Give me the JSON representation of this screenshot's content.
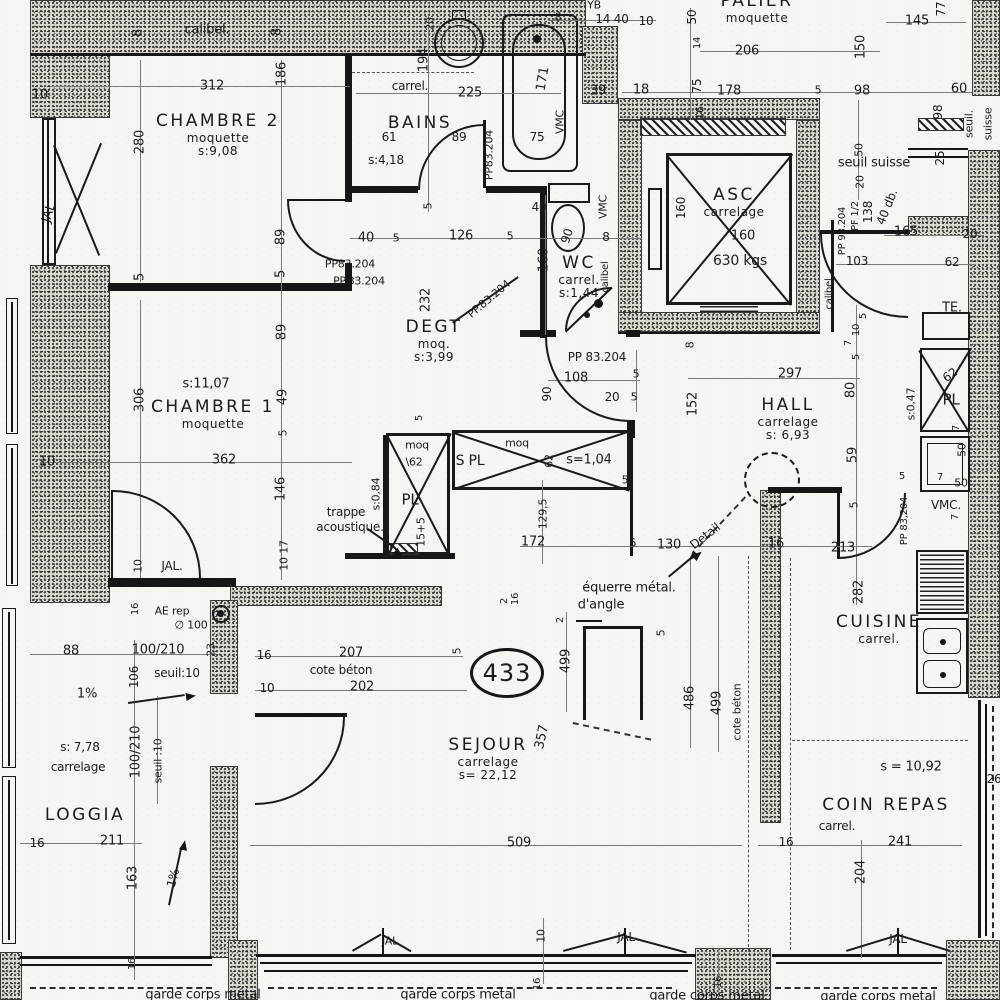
{
  "plan": {
    "number": "433",
    "rooms": [
      {
        "name": "CHAMBRE 2",
        "sub1": "moquette",
        "sub2": "s:9,08",
        "x": 218,
        "y": 112
      },
      {
        "name": "BAINS",
        "sub1": "",
        "sub2": "",
        "x": 420,
        "y": 114
      },
      {
        "name": "WC",
        "sub1": "carrel.",
        "sub2": "s:1,44",
        "x": 579,
        "y": 254
      },
      {
        "name": "DEGT",
        "sub1": "moq.",
        "sub2": "s:3,99",
        "x": 434,
        "y": 318
      },
      {
        "name": "PALIER",
        "sub1": "moquette",
        "sub2": "",
        "x": 757,
        "y": -8
      },
      {
        "name": "ASC",
        "sub1": "carrelage",
        "sub2": "",
        "x": 734,
        "y": 186
      },
      {
        "name": "HALL",
        "sub1": "carrelage",
        "sub2": "s: 6,93",
        "x": 788,
        "y": 396
      },
      {
        "name": "CHAMBRE 1",
        "sub1": "moquette",
        "sub2": "",
        "x": 213,
        "y": 398
      },
      {
        "name": "SEJOUR",
        "sub1": "carrelage",
        "sub2": "s= 22,12",
        "x": 488,
        "y": 736
      },
      {
        "name": "LOGGIA",
        "sub1": "",
        "sub2": "",
        "x": 85,
        "y": 806
      },
      {
        "name": "CUISINE",
        "sub1": "carrel.",
        "sub2": "",
        "x": 879,
        "y": 613
      },
      {
        "name": "COIN REPAS",
        "sub1": "",
        "sub2": "",
        "x": 886,
        "y": 796
      }
    ],
    "labels": [
      {
        "t": "10",
        "x": 40,
        "y": 95
      },
      {
        "t": "312",
        "x": 212,
        "y": 86
      },
      {
        "t": "8",
        "x": 138,
        "y": 33,
        "r": -90
      },
      {
        "t": "calibel.",
        "x": 207,
        "y": 30
      },
      {
        "t": "8",
        "x": 277,
        "y": 32,
        "r": -90
      },
      {
        "t": "186",
        "x": 282,
        "y": 74,
        "r": -90
      },
      {
        "t": "280",
        "x": 140,
        "y": 142,
        "r": -90
      },
      {
        "t": "5",
        "x": 140,
        "y": 277,
        "r": -90
      },
      {
        "t": "89",
        "x": 281,
        "y": 237,
        "r": -90
      },
      {
        "t": "5",
        "x": 281,
        "y": 274,
        "r": -90
      },
      {
        "t": "JAL",
        "x": 49,
        "y": 213,
        "r": -72
      },
      {
        "t": "20",
        "x": 430,
        "y": 24,
        "r": -90,
        "fs": 11
      },
      {
        "t": "194",
        "x": 424,
        "y": 60,
        "r": -90
      },
      {
        "t": "carrel.",
        "x": 410,
        "y": 86,
        "fs": 12
      },
      {
        "t": "225",
        "x": 470,
        "y": 93
      },
      {
        "t": "61",
        "x": 389,
        "y": 137,
        "fs": 12
      },
      {
        "t": "89",
        "x": 459,
        "y": 137,
        "fs": 12
      },
      {
        "t": "s:4,18",
        "x": 386,
        "y": 160,
        "fs": 12
      },
      {
        "t": "PP83.204",
        "x": 489,
        "y": 155,
        "r": -90,
        "fs": 11
      },
      {
        "t": "5",
        "x": 428,
        "y": 206,
        "r": -90,
        "fs": 11
      },
      {
        "t": "171",
        "x": 543,
        "y": 79,
        "r": -80
      },
      {
        "t": "75",
        "x": 537,
        "y": 137,
        "fs": 12
      },
      {
        "t": "VMC",
        "x": 560,
        "y": 122,
        "r": -90,
        "fs": 11
      },
      {
        "t": "8",
        "x": 558,
        "y": 17,
        "fs": 11
      },
      {
        "t": "14 40",
        "x": 612,
        "y": 19,
        "fs": 12
      },
      {
        "t": "10",
        "x": 646,
        "y": 21,
        "fs": 12
      },
      {
        "t": "YB",
        "x": 594,
        "y": 5,
        "fs": 11
      },
      {
        "t": "39",
        "x": 598,
        "y": 91
      },
      {
        "t": "18",
        "x": 641,
        "y": 90
      },
      {
        "t": "40",
        "x": 366,
        "y": 238
      },
      {
        "t": "5",
        "x": 396,
        "y": 238,
        "fs": 11
      },
      {
        "t": "126",
        "x": 461,
        "y": 236
      },
      {
        "t": "5",
        "x": 510,
        "y": 236,
        "fs": 11
      },
      {
        "t": "40",
        "x": 539,
        "y": 207,
        "fs": 12
      },
      {
        "t": "VMC",
        "x": 603,
        "y": 207,
        "r": -90,
        "fs": 11
      },
      {
        "t": "90",
        "x": 567,
        "y": 236,
        "r": -72,
        "fs": 12
      },
      {
        "t": "8",
        "x": 606,
        "y": 237,
        "fs": 12
      },
      {
        "t": "160",
        "x": 544,
        "y": 260,
        "r": -90
      },
      {
        "t": "calibel",
        "x": 606,
        "y": 277,
        "r": -90,
        "fs": 10
      },
      {
        "t": "PP 83.204",
        "x": 597,
        "y": 357,
        "fs": 12
      },
      {
        "t": "PP.83.204",
        "x": 489,
        "y": 299,
        "r": -40,
        "fs": 11
      },
      {
        "t": "108",
        "x": 576,
        "y": 378
      },
      {
        "t": "5",
        "x": 636,
        "y": 374,
        "fs": 11
      },
      {
        "t": "20",
        "x": 612,
        "y": 397,
        "fs": 12
      },
      {
        "t": "5",
        "x": 634,
        "y": 397,
        "fs": 11
      },
      {
        "t": "PP83.204",
        "x": 350,
        "y": 264,
        "fs": 11
      },
      {
        "t": "PP.83.204",
        "x": 359,
        "y": 281,
        "fs": 11
      },
      {
        "t": "232",
        "x": 426,
        "y": 300,
        "r": -90
      },
      {
        "t": "90",
        "x": 547,
        "y": 394,
        "r": -90,
        "fs": 12
      },
      {
        "t": "306",
        "x": 140,
        "y": 400,
        "r": -90
      },
      {
        "t": "s:11,07",
        "x": 206,
        "y": 384
      },
      {
        "t": "10",
        "x": 47,
        "y": 462
      },
      {
        "t": "362",
        "x": 224,
        "y": 460
      },
      {
        "t": "89",
        "x": 282,
        "y": 332,
        "r": -90
      },
      {
        "t": "49",
        "x": 283,
        "y": 397,
        "r": -90
      },
      {
        "t": "5",
        "x": 283,
        "y": 433,
        "r": -90,
        "fs": 11
      },
      {
        "t": "146",
        "x": 281,
        "y": 489,
        "r": -90
      },
      {
        "t": "17",
        "x": 284,
        "y": 547,
        "r": -90,
        "fs": 11
      },
      {
        "t": "10",
        "x": 284,
        "y": 564,
        "r": -90,
        "fs": 11
      },
      {
        "t": "trappe",
        "x": 346,
        "y": 512,
        "fs": 12
      },
      {
        "t": "acoustique.",
        "x": 350,
        "y": 527,
        "fs": 12
      },
      {
        "t": "10",
        "x": 138,
        "y": 566,
        "r": -90,
        "fs": 11
      },
      {
        "t": "JAL.",
        "x": 172,
        "y": 566,
        "fs": 12
      },
      {
        "t": "moq",
        "x": 417,
        "y": 445,
        "fs": 11
      },
      {
        "t": "\\62",
        "x": 414,
        "y": 462,
        "fs": 11
      },
      {
        "t": "5",
        "x": 420,
        "y": 418,
        "r": -90,
        "fs": 10
      },
      {
        "t": "S PL",
        "x": 470,
        "y": 461,
        "fs": 14
      },
      {
        "t": "moq",
        "x": 517,
        "y": 443,
        "fs": 11
      },
      {
        "t": "62",
        "x": 549,
        "y": 461,
        "r": -90,
        "fs": 11
      },
      {
        "t": "s=1,04",
        "x": 589,
        "y": 460,
        "fs": 13
      },
      {
        "t": "PL",
        "x": 410,
        "y": 500,
        "fs": 15
      },
      {
        "t": "s:0,84",
        "x": 376,
        "y": 494,
        "r": -90,
        "fs": 11
      },
      {
        "t": "15+5",
        "x": 421,
        "y": 532,
        "r": -90,
        "fs": 11
      },
      {
        "t": "172",
        "x": 533,
        "y": 542
      },
      {
        "t": "129,5",
        "x": 543,
        "y": 514,
        "r": -90,
        "fs": 11
      },
      {
        "t": "5",
        "x": 633,
        "y": 543,
        "fs": 11
      },
      {
        "t": "5",
        "x": 625,
        "y": 480,
        "fs": 11
      },
      {
        "t": "8",
        "x": 690,
        "y": 345,
        "r": -90,
        "fs": 11
      },
      {
        "t": "152",
        "x": 693,
        "y": 404,
        "r": -90
      },
      {
        "t": "297",
        "x": 790,
        "y": 374
      },
      {
        "t": "5",
        "x": 864,
        "y": 316,
        "r": -90,
        "fs": 10
      },
      {
        "t": "10",
        "x": 857,
        "y": 330,
        "r": -90,
        "fs": 10
      },
      {
        "t": "7",
        "x": 849,
        "y": 343,
        "r": -90,
        "fs": 10
      },
      {
        "t": "5",
        "x": 857,
        "y": 357,
        "r": -90,
        "fs": 10
      },
      {
        "t": "80",
        "x": 851,
        "y": 390,
        "r": -90
      },
      {
        "t": "59",
        "x": 853,
        "y": 455,
        "r": -90
      },
      {
        "t": "5",
        "x": 854,
        "y": 505,
        "r": -90,
        "fs": 11
      },
      {
        "t": "130",
        "x": 669,
        "y": 545
      },
      {
        "t": "Detail",
        "x": 705,
        "y": 536,
        "r": -38,
        "fs": 12
      },
      {
        "t": "16",
        "x": 776,
        "y": 544
      },
      {
        "t": "213",
        "x": 843,
        "y": 548
      },
      {
        "t": "282",
        "x": 859,
        "y": 592,
        "r": -90
      },
      {
        "t": "équerre métal.",
        "x": 629,
        "y": 588,
        "fs": 13
      },
      {
        "t": "d'angle",
        "x": 601,
        "y": 605,
        "fs": 13
      },
      {
        "t": "2",
        "x": 561,
        "y": 620,
        "r": -90,
        "fs": 10
      },
      {
        "t": "499",
        "x": 566,
        "y": 661,
        "r": -90
      },
      {
        "t": "5",
        "x": 661,
        "y": 633,
        "r": -90,
        "fs": 11
      },
      {
        "t": "486",
        "x": 690,
        "y": 698,
        "r": -90
      },
      {
        "t": "499",
        "x": 717,
        "y": 703,
        "r": -90
      },
      {
        "t": "cote béton",
        "x": 737,
        "y": 712,
        "r": -90,
        "fs": 11
      },
      {
        "t": "16",
        "x": 264,
        "y": 655,
        "fs": 12
      },
      {
        "t": "207",
        "x": 351,
        "y": 653
      },
      {
        "t": "cote béton",
        "x": 341,
        "y": 670,
        "fs": 12
      },
      {
        "t": "10",
        "x": 267,
        "y": 688,
        "fs": 12
      },
      {
        "t": "202",
        "x": 362,
        "y": 687
      },
      {
        "t": "5",
        "x": 457,
        "y": 651,
        "r": -90,
        "fs": 11
      },
      {
        "t": "16",
        "x": 516,
        "y": 599,
        "r": -90,
        "fs": 10
      },
      {
        "t": "2",
        "x": 505,
        "y": 601,
        "r": -90,
        "fs": 10
      },
      {
        "t": "357",
        "x": 542,
        "y": 737,
        "r": -78
      },
      {
        "t": "509",
        "x": 519,
        "y": 843
      },
      {
        "t": "10",
        "x": 541,
        "y": 936,
        "r": -90,
        "fs": 11
      },
      {
        "t": "JAL",
        "x": 626,
        "y": 937,
        "fs": 12
      },
      {
        "t": "JAL",
        "x": 390,
        "y": 941,
        "fs": 11
      },
      {
        "t": "16",
        "x": 538,
        "y": 984,
        "r": -90,
        "fs": 10
      },
      {
        "t": "16",
        "x": 719,
        "y": 982,
        "r": -90,
        "fs": 10
      },
      {
        "t": "88",
        "x": 71,
        "y": 651
      },
      {
        "t": "100/210",
        "x": 158,
        "y": 650,
        "fs": 13
      },
      {
        "t": "106",
        "x": 134,
        "y": 677,
        "r": -90,
        "fs": 12
      },
      {
        "t": "seuil:10",
        "x": 177,
        "y": 673,
        "fs": 12
      },
      {
        "t": "1%",
        "x": 87,
        "y": 694,
        "fs": 13
      },
      {
        "t": "s: 7,78",
        "x": 80,
        "y": 747,
        "fs": 12
      },
      {
        "t": "carrelage",
        "x": 78,
        "y": 767,
        "fs": 12
      },
      {
        "t": "100/210",
        "x": 136,
        "y": 752,
        "r": -90,
        "fs": 13
      },
      {
        "t": "seuil :10",
        "x": 158,
        "y": 761,
        "r": -90,
        "fs": 11
      },
      {
        "t": "16",
        "x": 37,
        "y": 843,
        "fs": 12
      },
      {
        "t": "211",
        "x": 112,
        "y": 841
      },
      {
        "t": "163",
        "x": 133,
        "y": 878,
        "r": -90
      },
      {
        "t": "1%",
        "x": 173,
        "y": 878,
        "r": -75,
        "fs": 12
      },
      {
        "t": "16",
        "x": 133,
        "y": 964,
        "r": -90,
        "fs": 10
      },
      {
        "t": "AE rep",
        "x": 172,
        "y": 611,
        "fs": 11
      },
      {
        "t": "∅ 100",
        "x": 191,
        "y": 625,
        "fs": 11
      },
      {
        "t": "23",
        "x": 211,
        "y": 650,
        "r": -90,
        "fs": 11
      },
      {
        "t": "16",
        "x": 136,
        "y": 609,
        "r": -90,
        "fs": 10
      },
      {
        "t": "50",
        "x": 692,
        "y": 17,
        "r": -90,
        "fs": 12
      },
      {
        "t": "145",
        "x": 917,
        "y": 21
      },
      {
        "t": "77",
        "x": 941,
        "y": 9,
        "r": -90,
        "fs": 12
      },
      {
        "t": "206",
        "x": 747,
        "y": 51
      },
      {
        "t": "14",
        "x": 698,
        "y": 43,
        "r": -90,
        "fs": 10
      },
      {
        "t": "150",
        "x": 861,
        "y": 47,
        "r": -90
      },
      {
        "t": "75",
        "x": 697,
        "y": 86,
        "r": -90,
        "fs": 12
      },
      {
        "t": "178",
        "x": 729,
        "y": 91
      },
      {
        "t": "5",
        "x": 818,
        "y": 90,
        "fs": 11
      },
      {
        "t": "98",
        "x": 862,
        "y": 91
      },
      {
        "t": "60",
        "x": 959,
        "y": 89
      },
      {
        "t": "16",
        "x": 700,
        "y": 113,
        "r": -90,
        "fs": 11
      },
      {
        "t": "98",
        "x": 938,
        "y": 112,
        "r": -90,
        "fs": 12
      },
      {
        "t": "seuil suisse",
        "x": 874,
        "y": 163,
        "fs": 13
      },
      {
        "t": "seuil.",
        "x": 969,
        "y": 124,
        "r": -90,
        "fs": 11
      },
      {
        "t": "suisse",
        "x": 988,
        "y": 124,
        "r": -90,
        "fs": 11
      },
      {
        "t": "25",
        "x": 940,
        "y": 158,
        "r": -90,
        "fs": 12
      },
      {
        "t": "50",
        "x": 859,
        "y": 150,
        "r": -90,
        "fs": 11
      },
      {
        "t": "20",
        "x": 860,
        "y": 182,
        "r": -90,
        "fs": 11
      },
      {
        "t": "160",
        "x": 681,
        "y": 208,
        "r": -90,
        "fs": 12
      },
      {
        "t": "160",
        "x": 743,
        "y": 236,
        "fs": 13
      },
      {
        "t": "630 kgs",
        "x": 740,
        "y": 261,
        "fs": 14
      },
      {
        "t": "calibel",
        "x": 830,
        "y": 294,
        "r": -90,
        "fs": 10
      },
      {
        "t": "PP 93.204",
        "x": 843,
        "y": 231,
        "r": -90,
        "fs": 10
      },
      {
        "t": "PF 1/2",
        "x": 856,
        "y": 216,
        "r": -90,
        "fs": 10
      },
      {
        "t": "138",
        "x": 868,
        "y": 212,
        "r": -90,
        "fs": 12
      },
      {
        "t": "40 db.",
        "x": 887,
        "y": 207,
        "r": -68,
        "fs": 12
      },
      {
        "t": "165",
        "x": 906,
        "y": 232
      },
      {
        "t": "20",
        "x": 970,
        "y": 234,
        "fs": 12
      },
      {
        "t": "103",
        "x": 857,
        "y": 261,
        "fs": 12
      },
      {
        "t": "62",
        "x": 952,
        "y": 262,
        "fs": 12
      },
      {
        "t": "TE.",
        "x": 952,
        "y": 308,
        "fs": 13
      },
      {
        "t": "62",
        "x": 950,
        "y": 375,
        "r": -35,
        "fs": 12
      },
      {
        "t": "PL",
        "x": 951,
        "y": 400,
        "fs": 15
      },
      {
        "t": "s:0,47",
        "x": 911,
        "y": 404,
        "r": -90,
        "fs": 11
      },
      {
        "t": "7",
        "x": 957,
        "y": 428,
        "r": -90,
        "fs": 10
      },
      {
        "t": "50",
        "x": 962,
        "y": 450,
        "r": -90,
        "fs": 11
      },
      {
        "t": "5",
        "x": 902,
        "y": 477,
        "fs": 10
      },
      {
        "t": "7",
        "x": 940,
        "y": 478,
        "fs": 10
      },
      {
        "t": "50",
        "x": 961,
        "y": 483,
        "fs": 11
      },
      {
        "t": "7",
        "x": 956,
        "y": 517,
        "r": -90,
        "fs": 10
      },
      {
        "t": "VMC.",
        "x": 946,
        "y": 505,
        "fs": 12
      },
      {
        "t": "PP 83,204",
        "x": 905,
        "y": 521,
        "r": -90,
        "fs": 10
      },
      {
        "t": "s = 10,92",
        "x": 911,
        "y": 767,
        "fs": 13
      },
      {
        "t": "carrel.",
        "x": 837,
        "y": 826,
        "fs": 12
      },
      {
        "t": "241",
        "x": 900,
        "y": 842
      },
      {
        "t": "16",
        "x": 786,
        "y": 842,
        "fs": 12
      },
      {
        "t": "204",
        "x": 861,
        "y": 872,
        "r": -90
      },
      {
        "t": "26",
        "x": 994,
        "y": 779,
        "fs": 12
      },
      {
        "t": "JAL",
        "x": 898,
        "y": 939,
        "fs": 12
      },
      {
        "t": "garde corps métal",
        "x": 203,
        "y": 995,
        "fs": 13
      },
      {
        "t": "garde corps metal",
        "x": 458,
        "y": 995,
        "fs": 13
      },
      {
        "t": "garde corps metal",
        "x": 707,
        "y": 996,
        "fs": 13
      },
      {
        "t": "garde corps metal",
        "x": 878,
        "y": 997,
        "fs": 13
      }
    ]
  }
}
